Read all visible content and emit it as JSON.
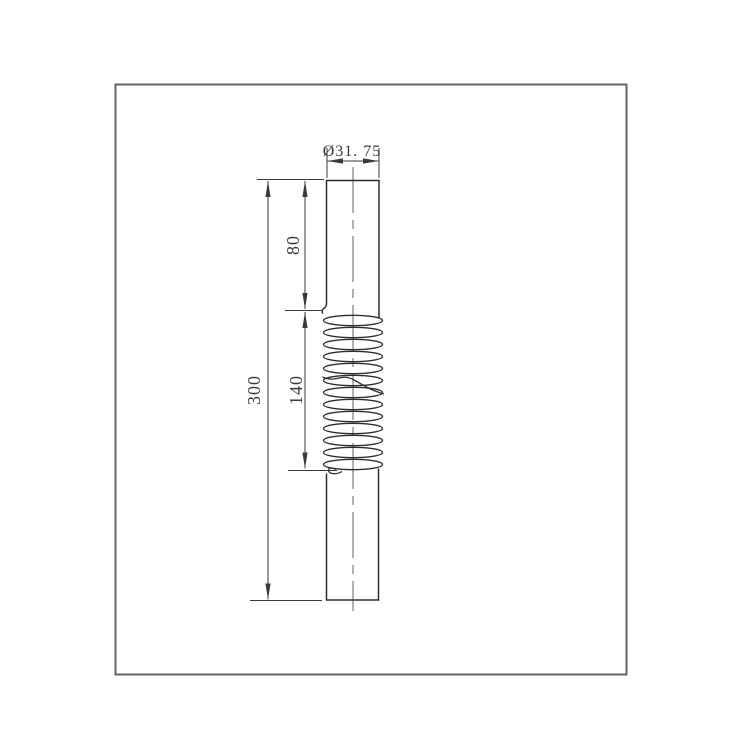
{
  "drawing": {
    "dimension_labels": {
      "diameter": "Ø31. 75",
      "upper_length": "80",
      "thread_length": "140",
      "overall_length": "300"
    },
    "colors": {
      "background": "#ffffff",
      "border": "#666666",
      "line": "#2f2f2f",
      "dimension": "#3a3a3a",
      "centerline": "#707070"
    }
  }
}
